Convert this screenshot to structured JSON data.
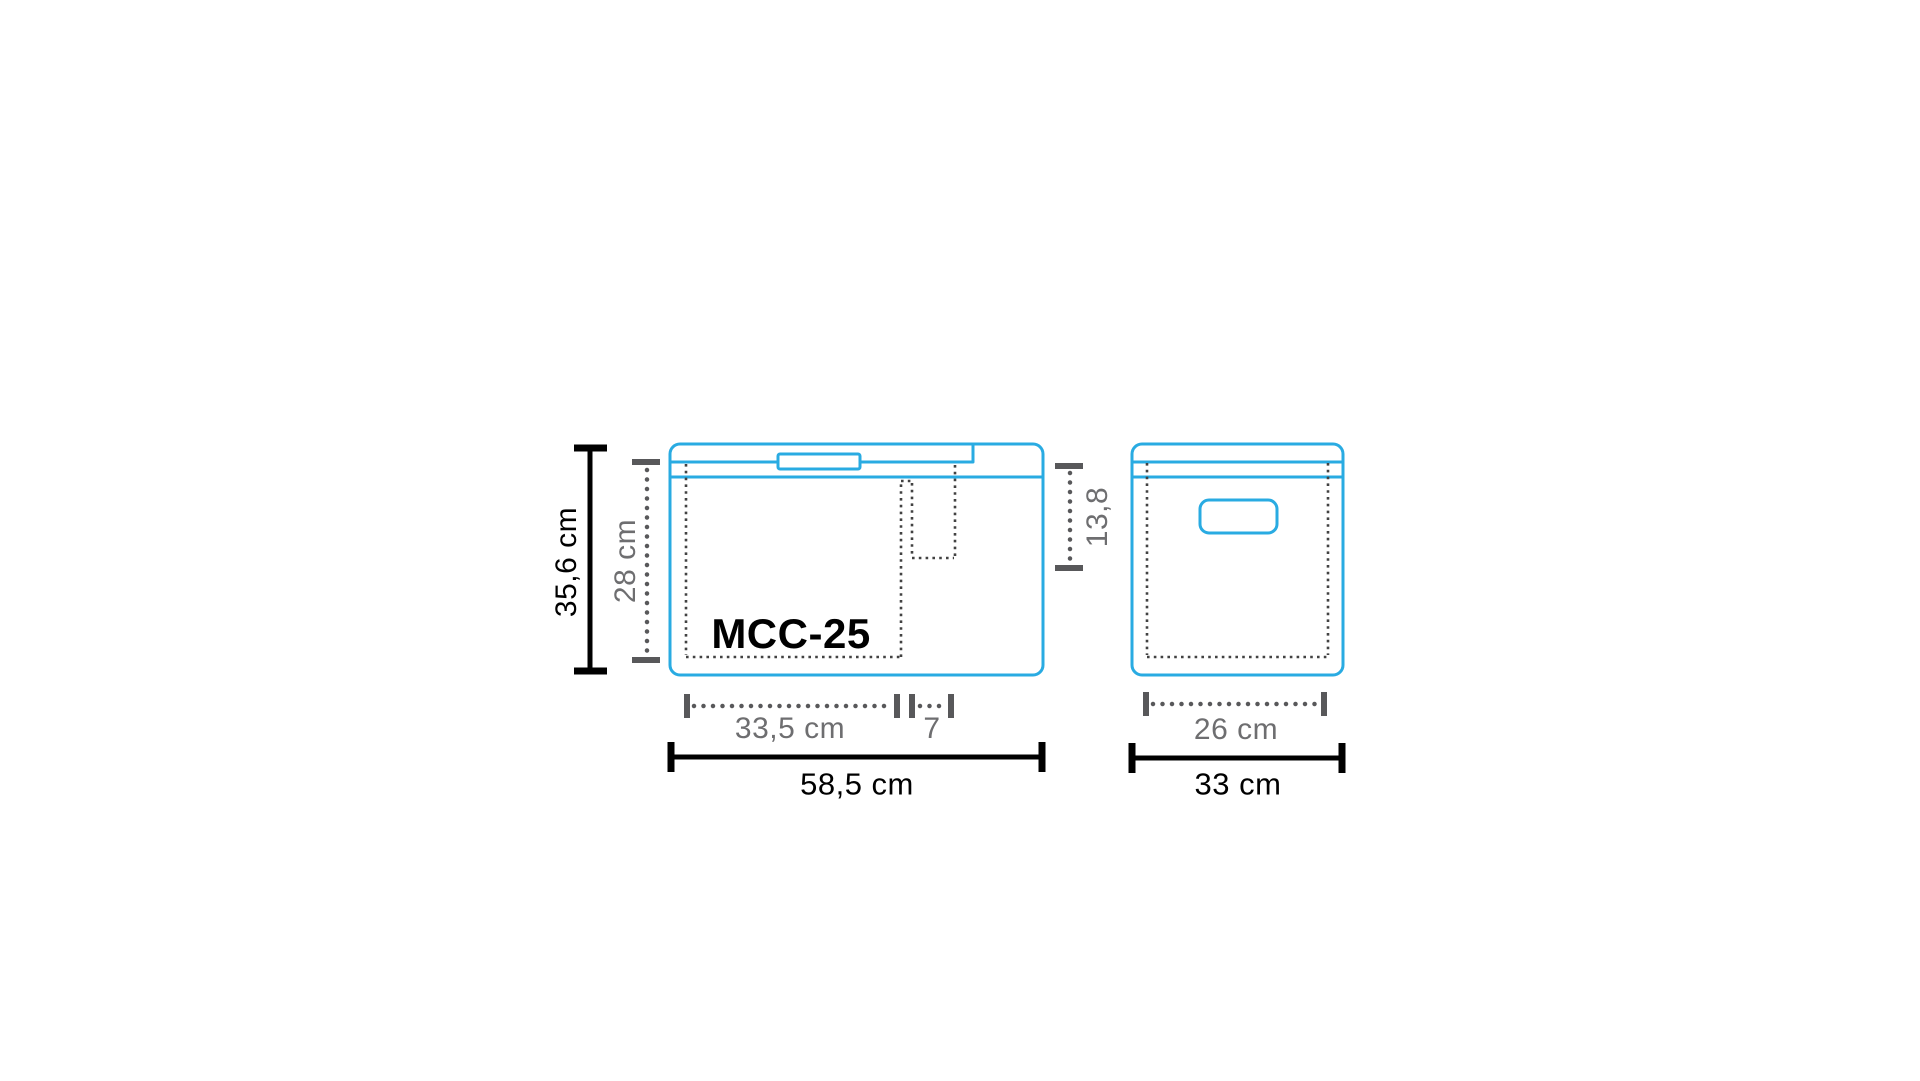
{
  "colors": {
    "outline-blue": "#29abe2",
    "line-black": "#000000",
    "dim-gray": "#58585a",
    "label-gray": "#6e6e70",
    "dashed-dark": "#424242",
    "background": "#ffffff"
  },
  "diagram": {
    "model": "MCC-25",
    "front_view": {
      "overall_height": "35,6 cm",
      "inner_height": "28 cm",
      "inner_width": "33,5 cm",
      "step_width": "7",
      "overall_width": "58,5 cm",
      "step_depth": "13,8"
    },
    "side_view": {
      "inner_width": "26 cm",
      "overall_width": "33 cm"
    }
  }
}
